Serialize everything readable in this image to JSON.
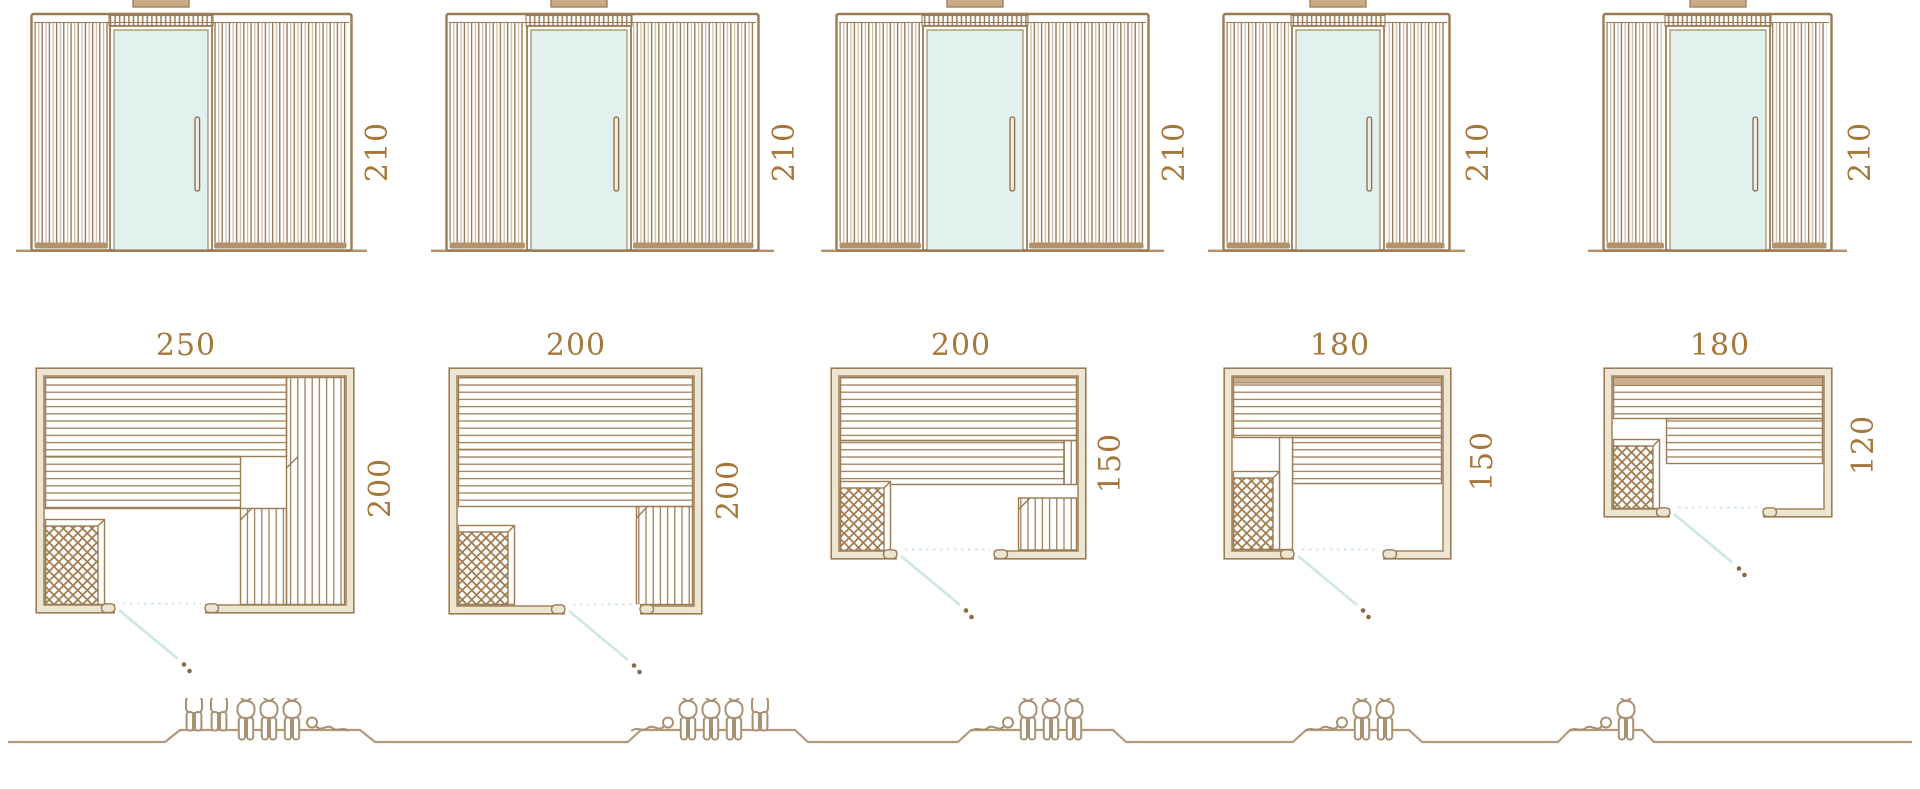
{
  "colors": {
    "wood_line": "#9b7b52",
    "wood_dark": "#8a6a42",
    "wall_fill": "#ece5d1",
    "slat_light": "#c8b296",
    "slat_dark": "#93714c",
    "glass_fill": "#e3f1ee",
    "dimension_text": "#a5773b",
    "figure_line": "#a89173",
    "ground_line": "#b3997a",
    "door_swing_line": "#cde8e1"
  },
  "models": [
    {
      "elevation_height": "210",
      "plan_width": "250",
      "plan_depth": "200",
      "capacity": {
        "standing": 2,
        "sitting": 3,
        "lying": 1,
        "total": 6
      }
    },
    {
      "elevation_height": "210",
      "plan_width": "200",
      "plan_depth": "200",
      "capacity": {
        "standing": 1,
        "sitting": 3,
        "lying": 1,
        "total": 5
      }
    },
    {
      "elevation_height": "210",
      "plan_width": "200",
      "plan_depth": "150",
      "capacity": {
        "standing": 0,
        "sitting": 3,
        "lying": 1,
        "total": 4
      }
    },
    {
      "elevation_height": "210",
      "plan_width": "180",
      "plan_depth": "150",
      "capacity": {
        "standing": 0,
        "sitting": 2,
        "lying": 1,
        "total": 3
      }
    },
    {
      "elevation_height": "210",
      "plan_width": "180",
      "plan_depth": "120",
      "capacity": {
        "standing": 0,
        "sitting": 1,
        "lying": 1,
        "total": 2
      }
    }
  ]
}
